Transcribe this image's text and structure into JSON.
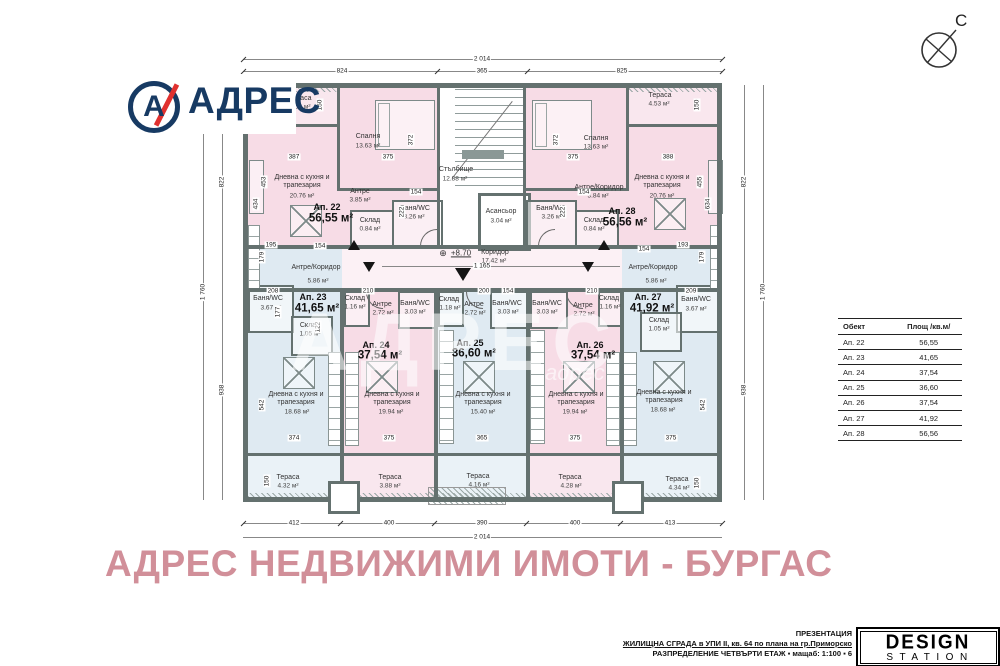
{
  "brand": {
    "logo_text": "АДРЕС",
    "logo_letter": "А",
    "navy": "#173a63",
    "red": "#e0312f"
  },
  "compass": {
    "north": "С"
  },
  "plan_watermark": {
    "big": "АДРЕС",
    "small": "адрес"
  },
  "footer_watermark": "АДРЕС НЕДВИЖИМИ ИМОТИ - БУРГАС",
  "footer_watermark_color": "#d18f99",
  "title_block": {
    "presentation": "ПРЕЗЕНТАЦИЯ",
    "project": "ЖИЛИЩНА СГРАДА в УПИ II, кв. 64 по плана на гр.Приморско",
    "sheet": "РАЗПРЕДЕЛЕНИЕ ЧЕТВЪРТИ ЕТАЖ ▪ мащаб: 1:100 ▪ 6",
    "studio_top": "DESIGN",
    "studio_bottom": "STATION"
  },
  "area_table": {
    "col_object": "Обект",
    "col_area": "Площ /кв.м/",
    "rows": [
      {
        "obj": "Ап. 22",
        "area": "56,55"
      },
      {
        "obj": "Ап. 23",
        "area": "41,65"
      },
      {
        "obj": "Ап. 24",
        "area": "37,54"
      },
      {
        "obj": "Ап. 25",
        "area": "36,60"
      },
      {
        "obj": "Ап. 26",
        "area": "37,54"
      },
      {
        "obj": "Ап. 27",
        "area": "41,92"
      },
      {
        "obj": "Ап. 28",
        "area": "56,56"
      }
    ]
  },
  "plan": {
    "level": "+8.70",
    "corridor_width": "1 165",
    "stairs": {
      "n": "Стълбище",
      "a": "12.88 м²"
    },
    "elevator": {
      "n": "Асансьор",
      "a": "3.04 м²"
    },
    "corridor": {
      "n": "Коридор",
      "a": "17.42 м²"
    },
    "ap22": {
      "id": "Ап. 22",
      "total": "56,55 м²",
      "bedroom": "Спалня",
      "bedroom_a": "13.63 м²",
      "living": "Дневна с кухня и трапезария",
      "living_a": "20.76 м²",
      "hall": "Антре",
      "hall_a": "3.85 м²",
      "bath": "Баня/WC",
      "bath_a": "3.26 м²",
      "storage": "Склад",
      "storage_a": "0.84 м²",
      "terrace": "Тераса",
      "terrace_a": "4.53 м²"
    },
    "ap28": {
      "id": "Ап. 28",
      "total": "56,56 м²",
      "bedroom": "Спалня",
      "bedroom_a": "13.63 м²",
      "living": "Дневна с кухня и трапезария",
      "living_a": "20.76 м²",
      "hall": "Антре/Коридор",
      "hall_a": "3.84 м²",
      "bath": "Баня/WC",
      "bath_a": "3.26 м²",
      "storage": "Склад",
      "storage_a": "0.84 м²",
      "terrace": "Тераса",
      "terrace_a": "4.53 м²"
    },
    "ap23": {
      "id": "Ап. 23",
      "total": "41,65 м²",
      "hall": "Антре/Коридор",
      "hall_a": "5.86 м²",
      "bath": "Баня/WC",
      "bath_a": "3.67 м²",
      "storage": "Склад",
      "storage_a": "1.05 м²",
      "living": "Дневна с кухня и трапезария",
      "living_a": "18.68 м²",
      "terrace": "Тераса",
      "terrace_a": "4.32 м²"
    },
    "ap24": {
      "id": "Ап. 24",
      "total": "37,54 м²",
      "hall": "Антре",
      "hall_a": "2.72 м²",
      "bath": "Баня/WC",
      "bath_a": "3.03 м²",
      "storage": "Склад",
      "storage_a": "1.16 м²",
      "living": "Дневна с кухня и трапезария",
      "living_a": "19.94 м²",
      "terrace": "Тераса",
      "terrace_a": "3.88 м²"
    },
    "ap25": {
      "id": "Ап. 25",
      "total": "36,60 м²",
      "hall": "Антре",
      "hall_a": "2.72 м²",
      "bath": "Баня/WC",
      "bath_a": "3.03 м²",
      "storage": "Склад",
      "storage_a": "1.18 м²",
      "living": "Дневна с кухня и трапезария",
      "living_a": "15.40 м²",
      "terrace": "Тераса",
      "terrace_a": "4.16 м²"
    },
    "ap26": {
      "id": "Ап. 26",
      "total": "37,54 м²",
      "hall": "Антре",
      "hall_a": "2.72 м²",
      "bath": "Баня/WC",
      "bath_a": "3.03 м²",
      "storage": "Склад",
      "storage_a": "1.16 м²",
      "living": "Дневна с кухня и трапезария",
      "living_a": "19.94 м²",
      "terrace": "Тераса",
      "terrace_a": "4.28 м²"
    },
    "ap27": {
      "id": "Ап. 27",
      "total": "41,92 м²",
      "hall": "Антре/Коридор",
      "hall_a": "5.86 м²",
      "bath": "Баня/WC",
      "bath_a": "3.67 м²",
      "storage": "Склад",
      "storage_a": "1.05 м²",
      "living": "Дневна с кухня и трапезария",
      "living_a": "18.68 м²",
      "terrace": "Тераса",
      "terrace_a": "4.34 м²"
    }
  },
  "dims": {
    "top_total": "2 014",
    "top_824": "824",
    "top_365": "365",
    "top_825": "825",
    "bottom_412": "412",
    "bottom_400a": "400",
    "bottom_390": "390",
    "bottom_400b": "400",
    "bottom_413": "413",
    "bottom_total": "2 014",
    "left_822": "822",
    "left_938": "938",
    "left_total": "1 760",
    "right_822": "822",
    "right_938": "938",
    "right_total": "1 760",
    "inner": [
      "387",
      "375",
      "372",
      "150",
      "375",
      "388",
      "372",
      "150",
      "453",
      "434",
      "455",
      "634",
      "154",
      "222",
      "154",
      "222",
      "195",
      "179",
      "193",
      "179",
      "208",
      "177",
      "210",
      "200",
      "154",
      "210",
      "209",
      "122",
      "374",
      "375",
      "365",
      "375",
      "375",
      "542",
      "542",
      "150",
      "150",
      "154",
      "154"
    ]
  }
}
